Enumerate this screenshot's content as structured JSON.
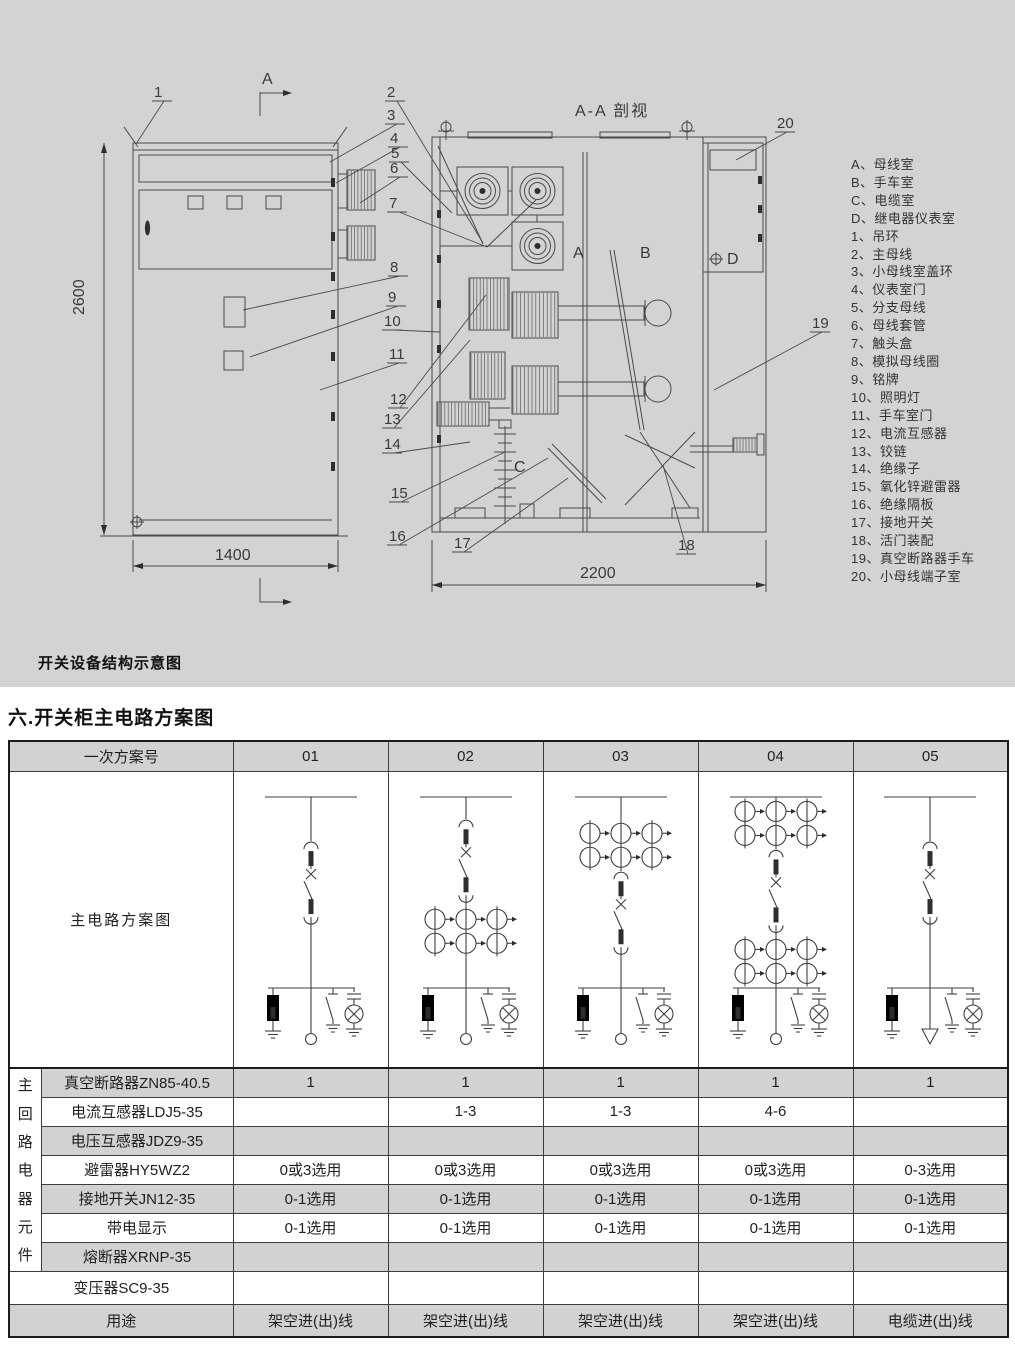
{
  "drawing": {
    "caption": "开关设备结构示意图",
    "section_view_title": "A-A 剖视",
    "view_arrow_label": "A",
    "dims": {
      "height": "2600",
      "width": "1400",
      "depth": "2200"
    },
    "compartments": {
      "a": "A",
      "b": "B",
      "c": "C",
      "d": "D"
    },
    "callouts": [
      "1",
      "2",
      "3",
      "4",
      "5",
      "6",
      "7",
      "8",
      "9",
      "10",
      "11",
      "12",
      "13",
      "14",
      "15",
      "16",
      "17",
      "18",
      "19",
      "20"
    ],
    "legend": [
      "A、母线室",
      "B、手车室",
      "C、电缆室",
      "D、继电器仪表室",
      "1、吊环",
      "2、主母线",
      "3、小母线室盖环",
      "4、仪表室门",
      "5、分支母线",
      "6、母线套管",
      "7、触头盒",
      "8、模拟母线圈",
      "9、铭牌",
      "10、照明灯",
      "11、手车室门",
      "12、电流互感器",
      "13、铰链",
      "14、绝缘子",
      "15、氧化锌避雷器",
      "16、绝缘隔板",
      "17、接地开关",
      "18、活门装配",
      "19、真空断路器手车",
      "20、小母线端子室"
    ]
  },
  "section_title": "六.开关柜主电路方案图",
  "table": {
    "corner_label": "一次方案号",
    "columns": [
      "01",
      "02",
      "03",
      "04",
      "05"
    ],
    "scheme_row_label": "主电路方案图",
    "side_label": "主回路电器元件",
    "schemes": [
      {
        "id": "01",
        "ct_top": false,
        "ct_bottom": false,
        "terminal": "ring"
      },
      {
        "id": "02",
        "ct_top": false,
        "ct_bottom": true,
        "terminal": "ring"
      },
      {
        "id": "03",
        "ct_top": true,
        "ct_bottom": false,
        "terminal": "ring"
      },
      {
        "id": "04",
        "ct_top": true,
        "ct_bottom": true,
        "terminal": "ring"
      },
      {
        "id": "05",
        "ct_top": false,
        "ct_bottom": false,
        "terminal": "cable"
      }
    ],
    "rows": [
      {
        "label": "真空断路器ZN85-40.5",
        "values": [
          "1",
          "1",
          "1",
          "1",
          "1"
        ],
        "shaded": true,
        "full": false
      },
      {
        "label": "电流互感器LDJ5-35",
        "values": [
          "",
          "1-3",
          "1-3",
          "4-6",
          ""
        ],
        "shaded": false,
        "full": false
      },
      {
        "label": "电压互感器JDZ9-35",
        "values": [
          "",
          "",
          "",
          "",
          ""
        ],
        "shaded": true,
        "full": false
      },
      {
        "label": "避雷器HY5WZ2",
        "values": [
          "0或3选用",
          "0或3选用",
          "0或3选用",
          "0或3选用",
          "0-3选用"
        ],
        "shaded": false,
        "full": false
      },
      {
        "label": "接地开关JN12-35",
        "values": [
          "0-1选用",
          "0-1选用",
          "0-1选用",
          "0-1选用",
          "0-1选用"
        ],
        "shaded": true,
        "full": false
      },
      {
        "label": "带电显示",
        "values": [
          "0-1选用",
          "0-1选用",
          "0-1选用",
          "0-1选用",
          "0-1选用"
        ],
        "shaded": false,
        "full": false
      },
      {
        "label": "熔断器XRNP-35",
        "values": [
          "",
          "",
          "",
          "",
          ""
        ],
        "shaded": true,
        "full": false
      },
      {
        "label": "变压器SC9-35",
        "values": [
          "",
          "",
          "",
          "",
          ""
        ],
        "shaded": false,
        "full": true
      },
      {
        "label": "用途",
        "values": [
          "架空进(出)线",
          "架空进(出)线",
          "架空进(出)线",
          "架空进(出)线",
          "电缆进(出)线"
        ],
        "shaded": true,
        "full": true
      }
    ]
  }
}
